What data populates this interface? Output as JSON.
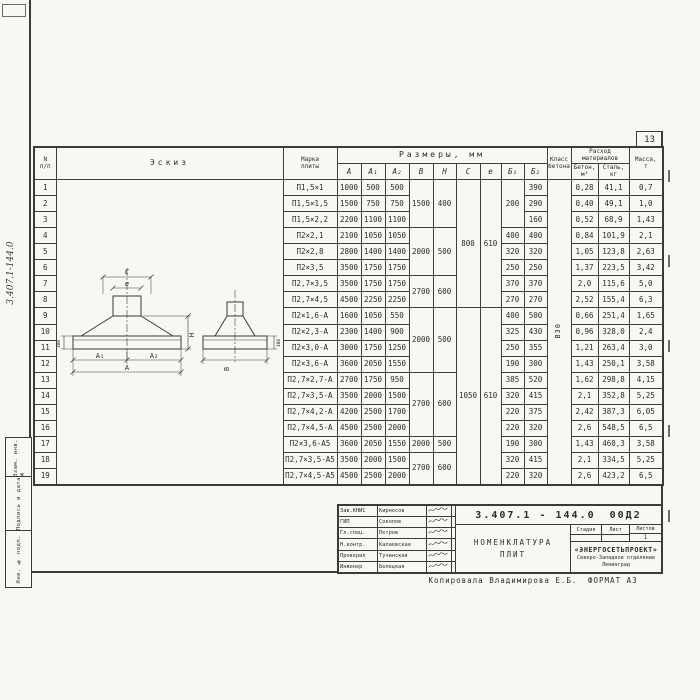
{
  "page": {
    "sheet_number": "13",
    "side_code": "3.407.1-144.0",
    "margin_stamps": [
      "Взам. инв. №",
      "Подпись и дата",
      "Инв. № подл."
    ],
    "copied_note": "Копировала Владимирова Е.Б.",
    "format_note": "ФОРМАТ А3"
  },
  "table": {
    "headers": {
      "num_top": "N",
      "num_bottom": "п/п",
      "sketch": "Эскиз",
      "mark_1": "Марка",
      "mark_2": "плиты",
      "dims_group": "Размеры, мм",
      "dim_cols": [
        "A",
        "A₁",
        "A₂",
        "B",
        "H",
        "C",
        "e",
        "Б₁",
        "Б₂"
      ],
      "class_1": "Класс",
      "class_2": "бетона",
      "cons_1": "Расход",
      "cons_2": "материалов",
      "concrete_1": "Бетон,",
      "concrete_2": "м³",
      "steel_1": "Сталь,",
      "steel_2": "кг",
      "mass_1": "Масса,",
      "mass_2": "т"
    },
    "concrete_class_value": "В30",
    "rows": [
      {
        "n": "1",
        "mark": "П1,5×1",
        "a": "1000",
        "a1": "500",
        "a2": "500",
        "b": {
          "v": "1500",
          "span": 3
        },
        "h": {
          "v": "400",
          "span": 3
        },
        "c": {
          "v": "800",
          "span": 8
        },
        "e": {
          "v": "610",
          "span": 8
        },
        "b1": {
          "v": "200",
          "span": 3
        },
        "b2": "390",
        "cls": {
          "v": "В30",
          "span": 19
        },
        "beton": "0,28",
        "stal": "41,1",
        "massa": "0,7"
      },
      {
        "n": "2",
        "mark": "П1,5×1,5",
        "a": "1500",
        "a1": "750",
        "a2": "750",
        "b2": "290",
        "beton": "0,40",
        "stal": "49,1",
        "massa": "1,0"
      },
      {
        "n": "3",
        "mark": "П1,5×2,2",
        "a": "2200",
        "a1": "1100",
        "a2": "1100",
        "b2": "160",
        "beton": "0,52",
        "stal": "68,9",
        "massa": "1,43"
      },
      {
        "n": "4",
        "mark": "П2×2,1",
        "a": "2100",
        "a1": "1050",
        "a2": "1050",
        "b": {
          "v": "2000",
          "span": 3
        },
        "h": {
          "v": "500",
          "span": 3
        },
        "b1": "400",
        "b2": "400",
        "beton": "0,84",
        "stal": "101,9",
        "massa": "2,1"
      },
      {
        "n": "5",
        "mark": "П2×2,8",
        "a": "2800",
        "a1": "1400",
        "a2": "1400",
        "b1": "320",
        "b2": "320",
        "beton": "1,05",
        "stal": "123,8",
        "massa": "2,63"
      },
      {
        "n": "6",
        "mark": "П2×3,5",
        "a": "3500",
        "a1": "1750",
        "a2": "1750",
        "b1": "250",
        "b2": "250",
        "beton": "1,37",
        "stal": "223,5",
        "massa": "3,42"
      },
      {
        "n": "7",
        "mark": "П2,7×3,5",
        "a": "3500",
        "a1": "1750",
        "a2": "1750",
        "b": {
          "v": "2700",
          "span": 2
        },
        "h": {
          "v": "600",
          "span": 2
        },
        "b1": "370",
        "b2": "370",
        "beton": "2,0",
        "stal": "115,6",
        "massa": "5,0"
      },
      {
        "n": "8",
        "mark": "П2,7×4,5",
        "a": "4500",
        "a1": "2250",
        "a2": "2250",
        "b1": "270",
        "b2": "270",
        "beton": "2,52",
        "stal": "155,4",
        "massa": "6,3"
      },
      {
        "n": "9",
        "mark": "П2×1,6-А",
        "a": "1600",
        "a1": "1050",
        "a2": "550",
        "b": {
          "v": "2000",
          "span": 4
        },
        "h": {
          "v": "500",
          "span": 4
        },
        "c": {
          "v": "1050",
          "span": 11
        },
        "e": {
          "v": "610",
          "span": 11
        },
        "b1": "400",
        "b2": "500",
        "beton": "0,66",
        "stal": "251,4",
        "massa": "1,65"
      },
      {
        "n": "10",
        "mark": "П2×2,3-А",
        "a": "2300",
        "a1": "1400",
        "a2": "900",
        "b1": "325",
        "b2": "430",
        "beton": "0,96",
        "stal": "328,0",
        "massa": "2,4"
      },
      {
        "n": "11",
        "mark": "П2×3,0-А",
        "a": "3000",
        "a1": "1750",
        "a2": "1250",
        "b1": "250",
        "b2": "355",
        "beton": "1,21",
        "stal": "263,4",
        "massa": "3,0"
      },
      {
        "n": "12",
        "mark": "П2×3,6-А",
        "a": "3600",
        "a1": "2050",
        "a2": "1550",
        "b1": "190",
        "b2": "300",
        "beton": "1,43",
        "stal": "250,1",
        "massa": "3,58"
      },
      {
        "n": "13",
        "mark": "П2,7×2,7-А",
        "a": "2700",
        "a1": "1750",
        "a2": "950",
        "b": {
          "v": "2700",
          "span": 4
        },
        "h": {
          "v": "600",
          "span": 4
        },
        "b1": "385",
        "b2": "520",
        "beton": "1,62",
        "stal": "298,8",
        "massa": "4,15"
      },
      {
        "n": "14",
        "mark": "П2,7×3,5-А",
        "a": "3500",
        "a1": "2000",
        "a2": "1500",
        "b1": "320",
        "b2": "415",
        "beton": "2,1",
        "stal": "352,8",
        "massa": "5,25"
      },
      {
        "n": "15",
        "mark": "П2,7×4,2-А",
        "a": "4200",
        "a1": "2500",
        "a2": "1700",
        "b1": "220",
        "b2": "375",
        "beton": "2,42",
        "stal": "387,3",
        "massa": "6,05"
      },
      {
        "n": "16",
        "mark": "П2,7×4,5-А",
        "a": "4500",
        "a1": "2500",
        "a2": "2000",
        "b1": "220",
        "b2": "320",
        "beton": "2,6",
        "stal": "548,5",
        "massa": "6,5"
      },
      {
        "n": "17",
        "mark": "П2×3,6-А5",
        "a": "3600",
        "a1": "2050",
        "a2": "1550",
        "b": "2000",
        "h": "500",
        "b1": "190",
        "b2": "300",
        "beton": "1,43",
        "stal": "460,3",
        "massa": "3,58"
      },
      {
        "n": "18",
        "mark": "П2,7×3,5-А5",
        "a": "3500",
        "a1": "2000",
        "a2": "1500",
        "b": {
          "v": "2700",
          "span": 2
        },
        "h": {
          "v": "600",
          "span": 2
        },
        "b1": "320",
        "b2": "415",
        "beton": "2,1",
        "stal": "334,5",
        "massa": "5,25"
      },
      {
        "n": "19",
        "mark": "П2,7×4,5-А5",
        "a": "4500",
        "a1": "2500",
        "a2": "2000",
        "b1": "220",
        "b2": "320",
        "beton": "2,6",
        "stal": "423,2",
        "massa": "6,5"
      }
    ]
  },
  "sketch": {
    "labels": {
      "c": "C",
      "e": "e",
      "a1": "A₁",
      "a2": "A₂",
      "a": "A",
      "b": "B",
      "h": "H",
      "t100": "100"
    }
  },
  "title_block": {
    "doc_number": "3.407.1 - 144.0",
    "doc_suffix": "00Д2",
    "title_line1": "НОМЕНКЛАТУРА",
    "title_line2": "ПЛИТ",
    "stage_label": "Стадия",
    "sheet_label": "Лист",
    "sheets_label": "Листов",
    "sheets_value": "1",
    "org_line1": "«ЭНЕРГОСЕТЬПРОЕКТ»",
    "org_line2": "Северо-Западное отделение",
    "org_line3": "Ленинград",
    "signatories": [
      {
        "role": "Зав.КНИС",
        "name": "Кирносов"
      },
      {
        "role": "ГИП",
        "name": "Соколов"
      },
      {
        "role": "Гл.спец.",
        "name": "Петров"
      },
      {
        "role": "Н.контр.",
        "name": "Калаевская"
      },
      {
        "role": "Проверил",
        "name": "Тучинская"
      },
      {
        "role": "Инженер",
        "name": "Белецкая"
      }
    ]
  }
}
